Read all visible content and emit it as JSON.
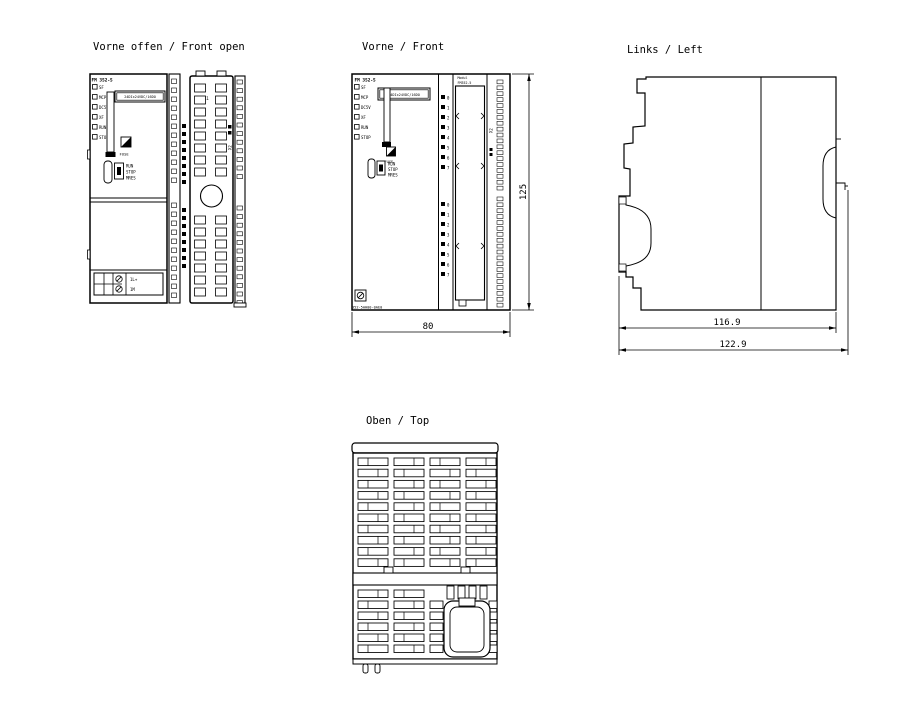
{
  "drawing": {
    "headers": {
      "front_open": "Vorne offen / Front open",
      "front": "Vorne / Front",
      "left": "Links / Left",
      "top": "Oben / Top"
    },
    "module": {
      "name": "FM 352-5",
      "led_labels": [
        "SF",
        "MCP",
        "DC5V",
        "XF",
        "RUN",
        "STOP"
      ],
      "type_plate": "24DIx24VDC/16DO",
      "fuse_label": "FUSE",
      "switch_labels": [
        "RUN",
        "STOP",
        "MRES"
      ],
      "power_terminal_labels": [
        "1L+",
        "1M"
      ],
      "connector_top_label": "X1",
      "connector_side_label": "X2",
      "door_label": [
        "Modul",
        "FM352-5"
      ],
      "order_number": "352-5AH00-0AE0",
      "channel_numbers": [
        "0",
        "1",
        "2",
        "3",
        "4",
        "5",
        "6",
        "7"
      ]
    },
    "dimensions": {
      "front_width_mm": "80",
      "front_height_mm": "125",
      "side_depth_inner_mm": "116.9",
      "side_depth_total_mm": "122.9"
    },
    "colors": {
      "line": "#000000",
      "background": "#ffffff"
    }
  }
}
